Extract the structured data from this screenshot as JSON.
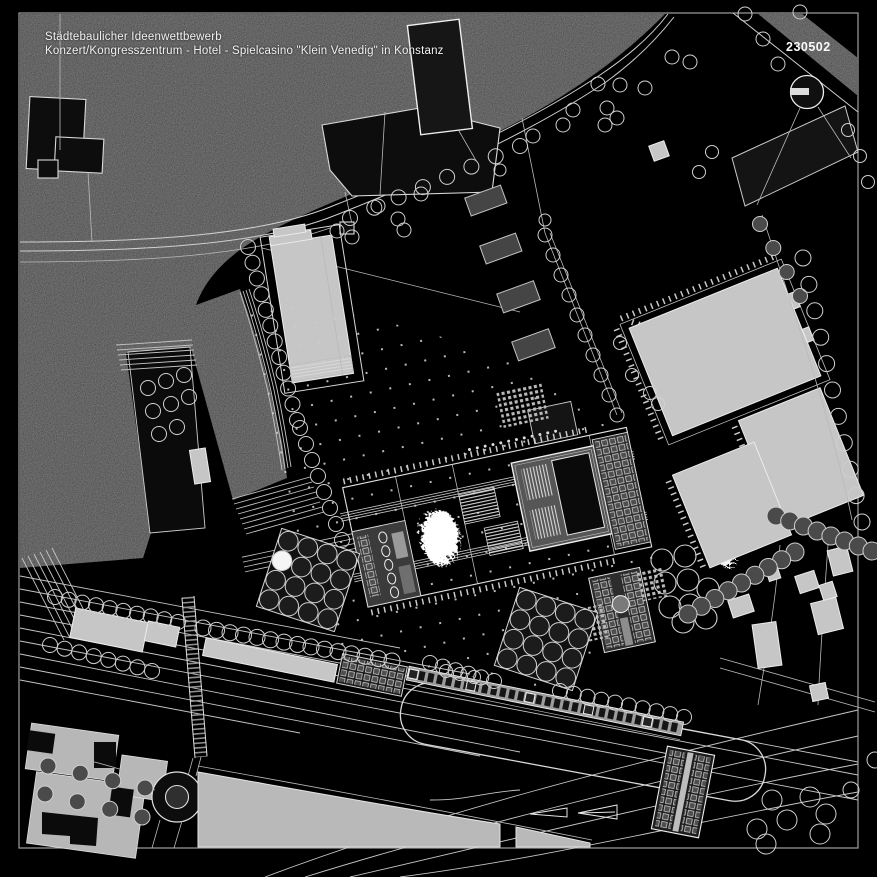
{
  "header": {
    "title_line1": "Städtebaulicher Ideenwettbewerb",
    "title_line2": "Konzert/Kongresszentrum - Hotel - Spielcasino \"Klein Venedig\" in Konstanz",
    "plan_number": "230502"
  },
  "colors": {
    "background": "#000000",
    "context_gray": "#3a3a3a",
    "line_white": "#e8e8e8",
    "building_light": "#c6c6c6",
    "building_dark": "#0d0d0d",
    "court_gray": "#454545",
    "highlight_white": "#ffffff"
  },
  "icons": {
    "gas_tank_symbol": "circle-with-bar",
    "tree_symbol": "circle",
    "footbridge_symbol": "hatched-band"
  }
}
